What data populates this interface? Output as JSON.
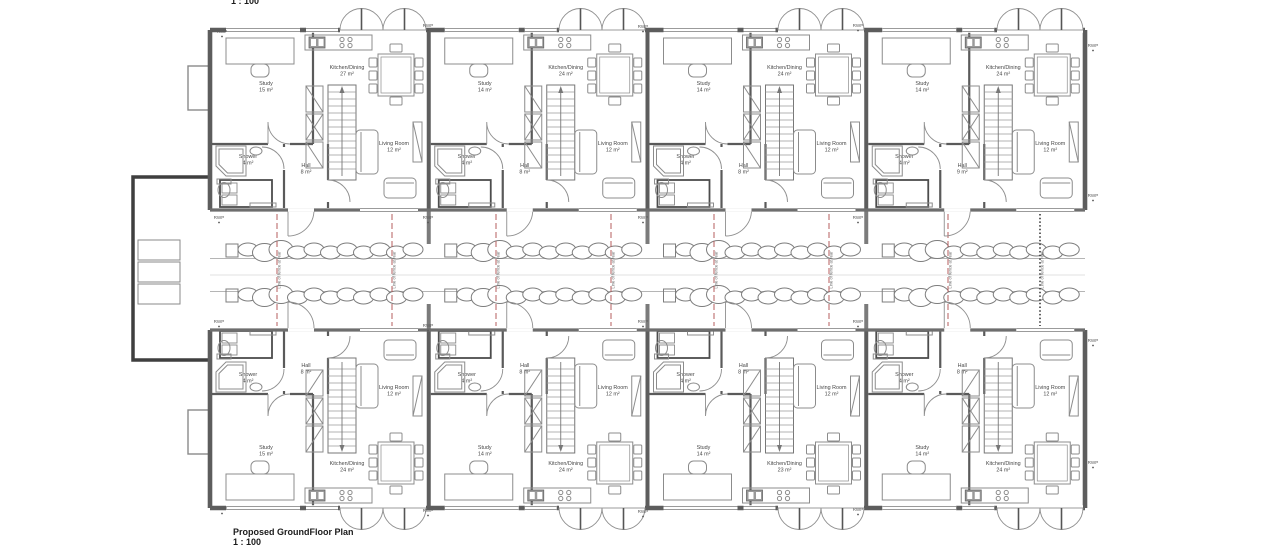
{
  "title": {
    "name": "Proposed GroundFloor Plan",
    "scale": "1 : 100",
    "top_scale_fragment": "1 : 100"
  },
  "labels": {
    "rwp": "RWP",
    "fence": "Line of fence at rear",
    "storage": "Secured Storage"
  },
  "colors": {
    "paper": "#ffffff",
    "wall": "#5d5d5d",
    "wall_light": "#8a8a8a",
    "interior_wall": "#5a5a5a",
    "furniture": "#8c8c8c",
    "text": "#474747",
    "fence_red": "#b65d5d",
    "fence_black": "#3a3a3a",
    "hedge": "#7d7d7d",
    "path_line": "#b5b5b5"
  },
  "units": [
    {
      "plot": "Plot 8",
      "occupancy": "2 Bed / 4 Person",
      "row": "top",
      "col": 0,
      "rooms": {
        "study": {
          "label": "Study",
          "area": "15 m²"
        },
        "kitchen": {
          "label": "Kitchen/Dining",
          "area": "27 m²"
        },
        "shower": {
          "label": "Shower",
          "area": "4 m²"
        },
        "hall": {
          "label": "Hall",
          "area": "8 m²"
        },
        "living": {
          "label": "Living Room",
          "area": "12 m²"
        }
      }
    },
    {
      "plot": "Plot 7",
      "occupancy": "2 Bed / 4 Person",
      "row": "top",
      "col": 1,
      "rooms": {
        "study": {
          "label": "Study",
          "area": "14 m²"
        },
        "kitchen": {
          "label": "Kitchen/Dining",
          "area": "24 m²"
        },
        "shower": {
          "label": "Shower",
          "area": "4 m²"
        },
        "hall": {
          "label": "Hall",
          "area": "8 m²"
        },
        "living": {
          "label": "Living Room",
          "area": "12 m²"
        }
      }
    },
    {
      "plot": "Plot 6",
      "occupancy": "2 Bed / 4 Person",
      "row": "top",
      "col": 2,
      "rooms": {
        "study": {
          "label": "Study",
          "area": "14 m²"
        },
        "kitchen": {
          "label": "Kitchen/Dining",
          "area": "24 m²"
        },
        "shower": {
          "label": "Shower",
          "area": "4 m²"
        },
        "hall": {
          "label": "Hall",
          "area": "8 m²"
        },
        "living": {
          "label": "Living Room",
          "area": "12 m²"
        }
      }
    },
    {
      "plot": "Plot 5",
      "occupancy": "2 Bed / 4 Person",
      "row": "top",
      "col": 3,
      "rooms": {
        "study": {
          "label": "Study",
          "area": "14 m²"
        },
        "kitchen": {
          "label": "Kitchen/Dining",
          "area": "24 m²"
        },
        "shower": {
          "label": "Shower",
          "area": "4 m²"
        },
        "hall": {
          "label": "Hall",
          "area": "9 m²"
        },
        "living": {
          "label": "Living Room",
          "area": "12 m²"
        }
      }
    },
    {
      "plot": "Plot 4",
      "occupancy": "2 Bed / 4 Person",
      "row": "bottom",
      "col": 0,
      "rooms": {
        "study": {
          "label": "Study",
          "area": "15 m²"
        },
        "kitchen": {
          "label": "Kitchen/Dining",
          "area": "24 m²"
        },
        "shower": {
          "label": "Shower",
          "area": "4 m²"
        },
        "hall": {
          "label": "Hall",
          "area": "8 m²"
        },
        "living": {
          "label": "Living Room",
          "area": "12 m²"
        }
      }
    },
    {
      "plot": "Plot 3",
      "occupancy": "2 Bed / 4 Person",
      "row": "bottom",
      "col": 1,
      "rooms": {
        "study": {
          "label": "Study",
          "area": "14 m²"
        },
        "kitchen": {
          "label": "Kitchen/Dining",
          "area": "24 m²"
        },
        "shower": {
          "label": "Shower",
          "area": "4 m²"
        },
        "hall": {
          "label": "Hall",
          "area": "8 m²"
        },
        "living": {
          "label": "Living Room",
          "area": "12 m²"
        }
      }
    },
    {
      "plot": "Plot 2",
      "occupancy": "2 Bed / 4 Person",
      "row": "bottom",
      "col": 2,
      "rooms": {
        "study": {
          "label": "Study",
          "area": "14 m²"
        },
        "kitchen": {
          "label": "Kitchen/Dining",
          "area": "23 m²"
        },
        "shower": {
          "label": "Shower",
          "area": "4 m²"
        },
        "hall": {
          "label": "Hall",
          "area": "8 m²"
        },
        "living": {
          "label": "Living Room",
          "area": "12 m²"
        }
      }
    },
    {
      "plot": "Plot 1",
      "occupancy": "2 Bed / 4 Person",
      "row": "bottom",
      "col": 3,
      "rooms": {
        "study": {
          "label": "Study",
          "area": "14 m²"
        },
        "kitchen": {
          "label": "Kitchen/Dining",
          "area": "24 m²"
        },
        "shower": {
          "label": "Shower",
          "area": "4 m²"
        },
        "hall": {
          "label": "Hall",
          "area": "8 m²"
        },
        "living": {
          "label": "Living Room",
          "area": "12 m²"
        }
      }
    }
  ],
  "rwp_positions": [
    {
      "x": 222,
      "y": 33
    },
    {
      "x": 428,
      "y": 27
    },
    {
      "x": 643,
      "y": 28
    },
    {
      "x": 858,
      "y": 27
    },
    {
      "x": 1093,
      "y": 47
    },
    {
      "x": 219,
      "y": 219
    },
    {
      "x": 428,
      "y": 219
    },
    {
      "x": 643,
      "y": 219
    },
    {
      "x": 858,
      "y": 219
    },
    {
      "x": 1093,
      "y": 197
    },
    {
      "x": 219,
      "y": 323
    },
    {
      "x": 428,
      "y": 327
    },
    {
      "x": 643,
      "y": 323
    },
    {
      "x": 858,
      "y": 323
    },
    {
      "x": 1093,
      "y": 342
    },
    {
      "x": 222,
      "y": 510
    },
    {
      "x": 428,
      "y": 512
    },
    {
      "x": 643,
      "y": 513
    },
    {
      "x": 858,
      "y": 511
    },
    {
      "x": 1093,
      "y": 464
    }
  ],
  "fence_lines": [
    {
      "x": 277,
      "style": "red"
    },
    {
      "x": 392,
      "style": "red"
    },
    {
      "x": 496,
      "style": "red"
    },
    {
      "x": 611,
      "style": "red"
    },
    {
      "x": 714,
      "style": "red"
    },
    {
      "x": 829,
      "style": "red"
    },
    {
      "x": 948,
      "style": "red"
    },
    {
      "x": 1040,
      "style": "black"
    }
  ],
  "building": {
    "left": 210,
    "right": 1085,
    "top": 30,
    "bottom": 508,
    "garden_top": 210,
    "garden_bottom": 330,
    "bays": 4
  }
}
